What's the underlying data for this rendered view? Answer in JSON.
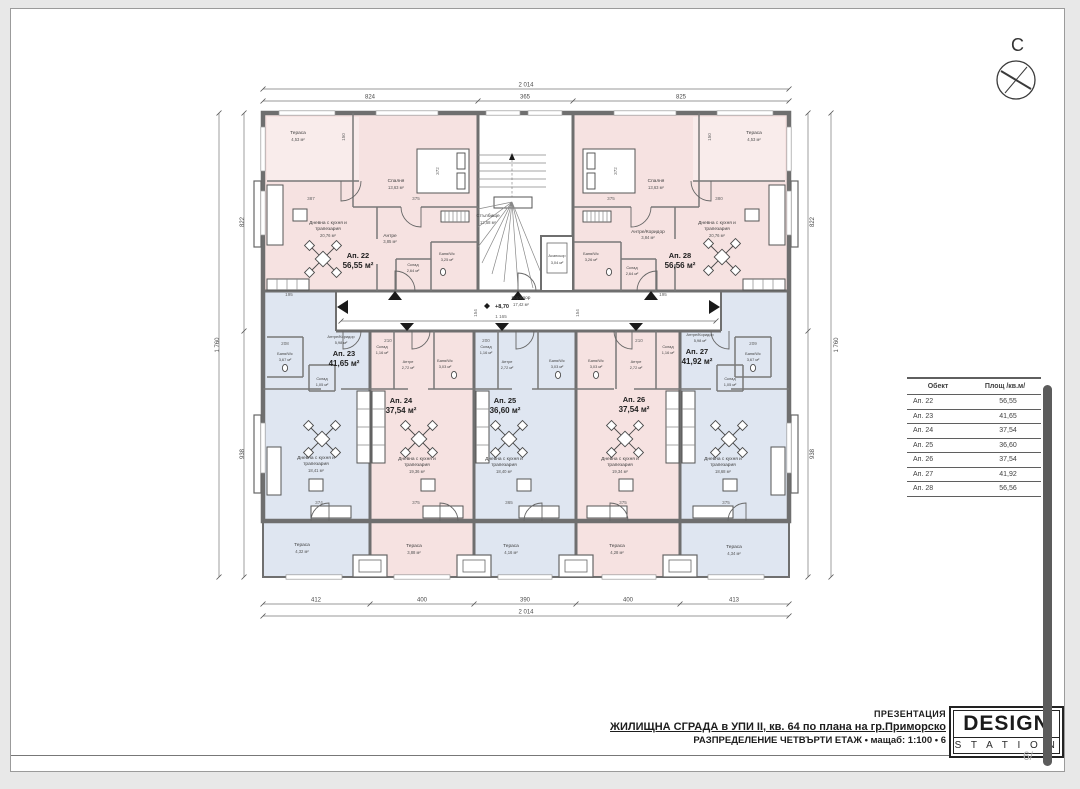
{
  "compass": {
    "letter": "С"
  },
  "rooms": {
    "terrace": "Тераса",
    "bedroom": "Спалня",
    "living1": "Дневна с кухня и",
    "living2": "трапезария",
    "hall": "Антре",
    "hall_corridor": "Антре/Коридор",
    "corridor": "Коридор",
    "bath": "Баня/Wc",
    "storage": "Склад",
    "stairs": "Стълбище",
    "elevator": "Асансьор"
  },
  "core": {
    "stairs_area": "12,58 м²",
    "elevator_area": "3,04 м²",
    "corridor_area": "17,42 м²",
    "level": "+8,70"
  },
  "apartments": {
    "a22": {
      "id": "Ап. 22",
      "total": "56,55 м²",
      "terrace": "4,53 м²",
      "bedroom": "13,63 м²",
      "living": "20,76 м²",
      "hall": "3,85 м²",
      "bath": "3,25 м²",
      "storage": "2,64 м²"
    },
    "a23": {
      "id": "Ап. 23",
      "total": "41,65 м²",
      "living": "18,41 м²",
      "hall": "5,98 м²",
      "bath": "3,67 м²",
      "storage": "1,05 м²",
      "terrace": "4,32 м²"
    },
    "a24": {
      "id": "Ап. 24",
      "total": "37,54 м²",
      "living": "19,36 м²",
      "hall": "2,72 м²",
      "bath": "3,03 м²",
      "storage": "1,16 м²",
      "terrace": "3,88 м²"
    },
    "a25": {
      "id": "Ап. 25",
      "total": "36,60 м²",
      "living": "18,40 м²",
      "hall": "2,72 м²",
      "bath": "3,03 м²",
      "storage": "1,16 м²",
      "terrace": "4,16 м²"
    },
    "a26": {
      "id": "Ап. 26",
      "total": "37,54 м²",
      "living": "19,34 м²",
      "hall": "2,72 м²",
      "bath": "3,03 м²",
      "storage": "1,16 м²",
      "terrace": "4,28 м²"
    },
    "a27": {
      "id": "Ап. 27",
      "total": "41,92 м²",
      "living": "18,68 м²",
      "hall": "5,98 м²",
      "bath": "3,67 м²",
      "storage": "1,05 м²",
      "terrace": "4,34 м²"
    },
    "a28": {
      "id": "Ап. 28",
      "total": "56,56 м²",
      "terrace": "4,53 м²",
      "bedroom": "13,63 м²",
      "living": "20,76 м²",
      "hall": "3,84 м²",
      "bath": "3,26 м²",
      "storage": "2,64 м²"
    }
  },
  "dims": {
    "top_total": "2 014",
    "top_segs": [
      "824",
      "365",
      "825"
    ],
    "bottom_segs": [
      "412",
      "400",
      "390",
      "400",
      "413"
    ],
    "bottom_total": "2 014",
    "left_segs": [
      "822",
      "938"
    ],
    "left_total": "1 760",
    "right_segs": [
      "822",
      "938"
    ],
    "right_total": "1 760",
    "corridor_width": "1 165",
    "interior": {
      "d387": "387",
      "d375": "375",
      "d380": "380",
      "d372": "372",
      "d150": "150",
      "d374": "374",
      "d365": "365",
      "d208": "208",
      "d209": "209",
      "d210": "210",
      "d200": "200",
      "d195": "195",
      "d154": "154"
    }
  },
  "area_table": {
    "col_object": "Обект",
    "col_area": "Площ /кв.м/",
    "rows": [
      {
        "obj": "Ап. 22",
        "area": "56,55"
      },
      {
        "obj": "Ап. 23",
        "area": "41,65"
      },
      {
        "obj": "Ап. 24",
        "area": "37,54"
      },
      {
        "obj": "Ап. 25",
        "area": "36,60"
      },
      {
        "obj": "Ап. 26",
        "area": "37,54"
      },
      {
        "obj": "Ап. 27",
        "area": "41,92"
      },
      {
        "obj": "Ап. 28",
        "area": "56,56"
      }
    ]
  },
  "title_block": {
    "presentation": "ПРЕЗЕНТАЦИЯ",
    "building": "ЖИЛИЩНА СГРАДА в УПИ II, кв. 64 по плана на гр.Приморско",
    "distribution": "РАЗПРЕДЕЛЕНИЕ ЧЕТВЪРТИ ЕТАЖ • мащаб: 1:100 • 6"
  },
  "logo": {
    "line1": "DESIGN",
    "line2": "S T A T I O N"
  },
  "page_number": "6/",
  "colors": {
    "apartment_pink": "#f6e2e1",
    "apartment_blue": "#dfe6f1",
    "wall_gray": "#6f6f6f"
  }
}
